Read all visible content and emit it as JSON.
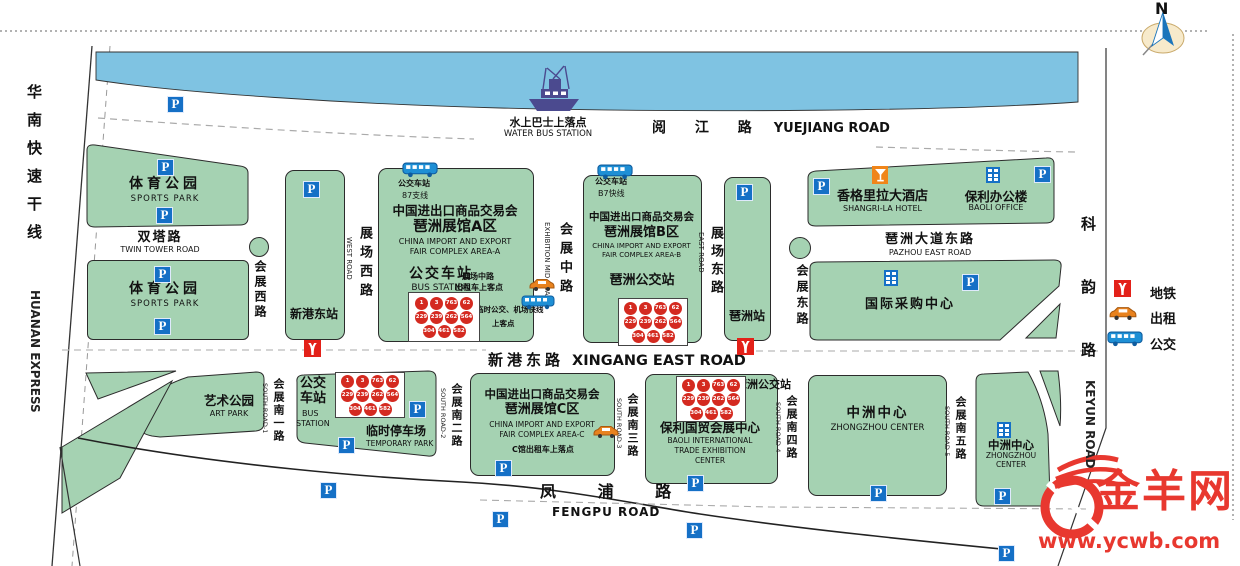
{
  "parking_label": "P",
  "compass_label": "N",
  "legend": {
    "metro_label": "地铁",
    "taxi_label": "出租",
    "bus_label": "公交"
  },
  "water_bus": {
    "cn": "水上巴士上落点",
    "en": "WATER BUS STATION"
  },
  "roads": {
    "yuejiang": {
      "cn": "阅 江 路",
      "en": "YUEJIANG ROAD"
    },
    "huanan": {
      "cn": "华南快速干线",
      "en": "HUANAN EXPRESS"
    },
    "twin_tower": {
      "cn": "双塔路",
      "en": "TWIN TOWER ROAD"
    },
    "huizhan_west": {
      "cn": "会展西路"
    },
    "zhanchang_west": {
      "cn": "展场西路",
      "en": "WEST ROAD"
    },
    "huizhan_mid": {
      "cn": "会展中路",
      "en": "EXHIBITION MID ROAD"
    },
    "zhanchang_east": {
      "cn": "展场东路",
      "en": "EAST ROAD"
    },
    "huizhan_east": {
      "cn": "会展东路"
    },
    "pazhou_ave": {
      "cn": "琶洲大道东路",
      "en": "PAZHOU EAST ROAD"
    },
    "keyun": {
      "cn": "科韵路",
      "en": "KEYUN ROAD"
    },
    "xingang": {
      "cn": "新港东路",
      "en": "XINGANG EAST ROAD"
    },
    "fengpu": {
      "cn": "凤 浦 路",
      "en": "FENGPU ROAD"
    },
    "south1": {
      "cn": "会展南一路",
      "en": "SOUTH ROAD-1"
    },
    "south2": {
      "cn": "会展南二路",
      "en": "SOUTH ROAD-2"
    },
    "south3": {
      "cn": "会展南三路",
      "en": "SOUTH ROAD-3"
    },
    "south4": {
      "cn": "会展南四路",
      "en": "SOUTH ROAD-4"
    },
    "south5": {
      "cn": "会展南五路",
      "en": "SOUTH ROAD-5"
    }
  },
  "blocks": {
    "sports_park_n": {
      "cn": "体育公园",
      "en": "SPORTS PARK"
    },
    "sports_park_s": {
      "cn": "体育公园",
      "en": "SPORTS PARK"
    },
    "xingang_station": {
      "cn": "新港东站"
    },
    "area_a": {
      "stop_cn": "公交车站",
      "line": "87支线",
      "title": "中国进出口商品交易会",
      "subtitle": "琶洲展馆A区",
      "en1": "CHINA IMPORT AND EXPORT",
      "en2": "FAIR COMPLEX AREA-A",
      "station_cn": "公交车站",
      "station_en": "BUS STATION",
      "taxi1": "展场中路",
      "taxi2": "出租车上客点",
      "temp1": "临时公交、机场快线",
      "temp2": "上客点"
    },
    "area_b": {
      "stop_cn": "公交车站",
      "line": "B7快线",
      "title": "中国进出口商品交易会",
      "subtitle": "琶洲展馆B区",
      "en1": "CHINA IMPORT AND EXPORT",
      "en2": "FAIR COMPLEX AREA-B",
      "station_cn": "琶洲公交站"
    },
    "pazhou_station": {
      "cn": "琶洲站"
    },
    "shangrila": {
      "cn": "香格里拉大酒店",
      "en": "SHANGRI-LA HOTEL"
    },
    "baoli_office": {
      "cn": "保利办公楼",
      "en": "BAOLI OFFICE"
    },
    "sourcing_center": {
      "cn": "国际采购中心"
    },
    "art_park": {
      "cn": "艺术公园",
      "en": "ART PARK"
    },
    "bus_station_sw": {
      "cn1": "公交",
      "cn2": "车站",
      "en1": "BUS",
      "en2": "STATION",
      "temp_cn": "临时停车场",
      "temp_en": "TEMPORARY PARK"
    },
    "area_c": {
      "title": "中国进出口商品交易会",
      "subtitle": "琶洲展馆C区",
      "en1": "CHINA IMPORT AND EXPORT",
      "en2": "FAIR COMPLEX AREA-C",
      "taxi": "C馆出租车上落点"
    },
    "baoli_expo": {
      "bus_label": "琶洲公交站",
      "cn": "保利国贸会展中心",
      "en1": "BAOLI INTERNATIONAL",
      "en2": "TRADE EXHIBITION",
      "en3": "CENTER"
    },
    "zhongzhou_a": {
      "cn": "中洲中心",
      "en": "ZHONGZHOU CENTER"
    },
    "zhongzhou_b": {
      "cn": "中洲中心",
      "en1": "ZHONGZHOU",
      "en2": "CENTER"
    }
  },
  "bus_routes": [
    "1",
    "3",
    "763",
    "62",
    "229",
    "239",
    "262",
    "564",
    "304",
    "461",
    "582"
  ],
  "logo": {
    "name": "金羊网",
    "url": "www.ycwb.com"
  },
  "colors": {
    "block_green": "#A5D2B2",
    "river_blue": "#7FC3E2",
    "parking_blue": "#1570C6",
    "metro_red": "#E32119",
    "badge_red": "#D42A20",
    "taxi_orange": "#E8821E",
    "bus_blue": "#1E8FD5",
    "hotel_orange": "#F08519",
    "logo_red": "#E8382F"
  }
}
